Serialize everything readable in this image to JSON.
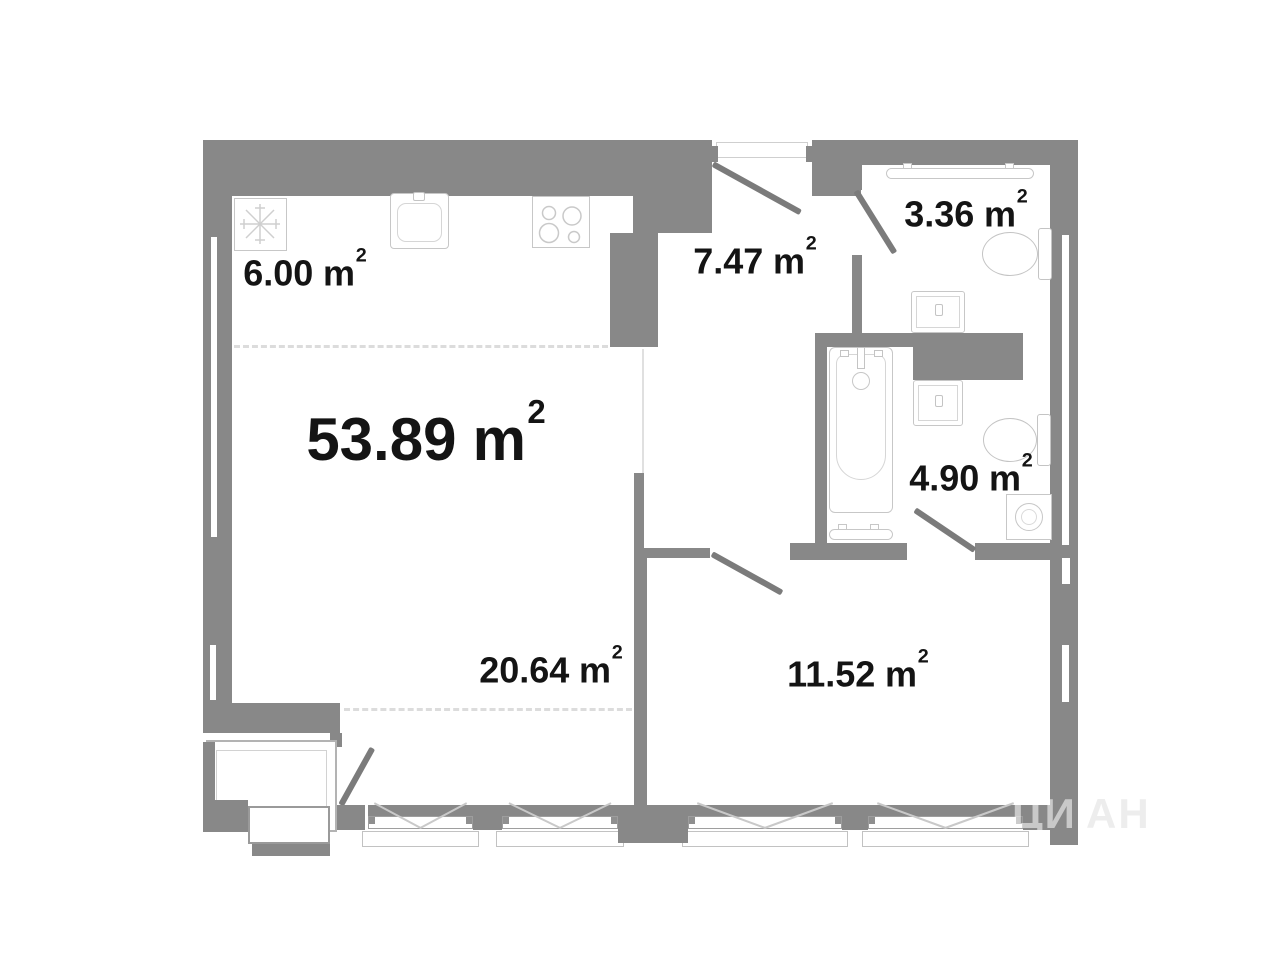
{
  "plan": {
    "title": "apartment floor plan",
    "rooms": [
      {
        "name": "total-apartment",
        "area": "53.89",
        "unit": "m",
        "sup": "2"
      },
      {
        "name": "kitchen-zone",
        "area": "6.00",
        "unit": "m",
        "sup": "2"
      },
      {
        "name": "hallway",
        "area": "7.47",
        "unit": "m",
        "sup": "2"
      },
      {
        "name": "wc",
        "area": "3.36",
        "unit": "m",
        "sup": "2"
      },
      {
        "name": "bathroom",
        "area": "4.90",
        "unit": "m",
        "sup": "2"
      },
      {
        "name": "living-zone",
        "area": "20.64",
        "unit": "m",
        "sup": "2"
      },
      {
        "name": "bedroom",
        "area": "11.52",
        "unit": "m",
        "sup": "2"
      }
    ],
    "watermark": {
      "primary": "ЦИ",
      "secondary": "АН"
    },
    "icons": [
      "refrigerator-icon",
      "kitchen-sink-icon",
      "stove-icon",
      "towel-rail-icon",
      "toilet-icon",
      "wash-basin-icon",
      "bathtub-icon",
      "washing-machine-icon",
      "door-swing-icon",
      "window-icon"
    ],
    "colors": {
      "wall": "#888888",
      "fixture_outline": "#c7c7c7",
      "door_leaf": "#7b7b7b",
      "dashed_line": "#dcdcdc",
      "label_text": "#141414"
    }
  }
}
